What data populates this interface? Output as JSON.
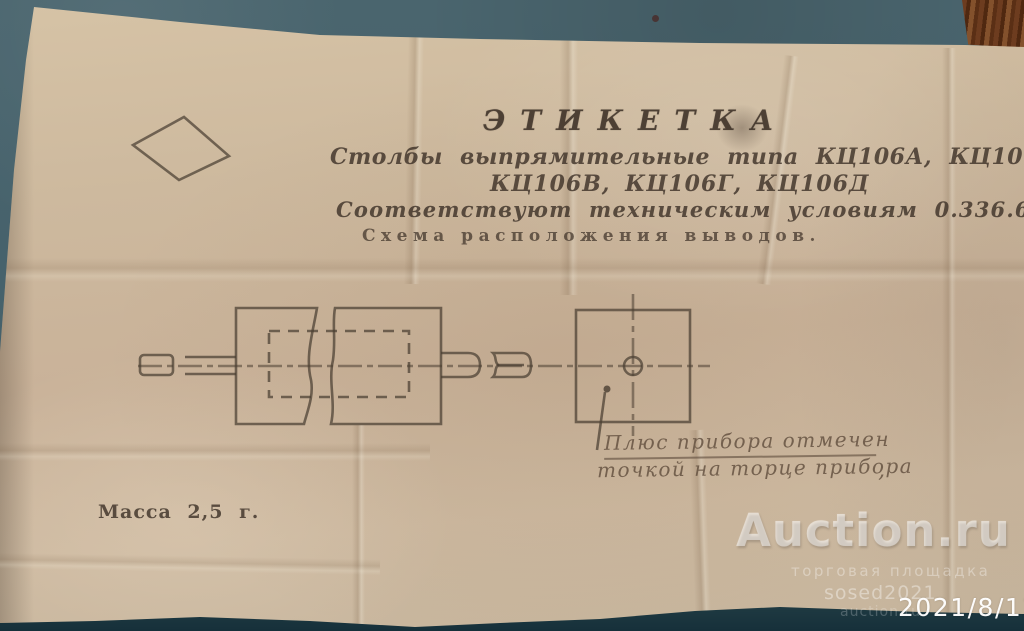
{
  "photo": {
    "background_color": "#45616b",
    "paper_color": "#cbb79c",
    "ink_color": "#4a3c30",
    "wood_color": "#6d3c1f",
    "watermark_color": "#ffffff"
  },
  "label": {
    "title": "ЭТИКЕТКА",
    "type_line1": "Столбы выпрямительные типа КЦ106А, КЦ106Б,",
    "type_line2": "КЦ106В, КЦ106Г, КЦ106Д",
    "spec_line": "Соответствуют техническим условиям 0.336.600ТУ",
    "scheme_line": "Схема расположения выводов.",
    "mass_line": "Масса 2,5 г.",
    "handwritten_note_line1": "Плюс прибора отмечен",
    "handwritten_note_line2": "точкой на торце прибора",
    "handwritten_comma": ","
  },
  "watermark": {
    "brand": "Auction.ru",
    "tagline": "торговая площадка",
    "seller": "sosed2021",
    "site": "auction.ru",
    "date": "2021/8/12"
  }
}
